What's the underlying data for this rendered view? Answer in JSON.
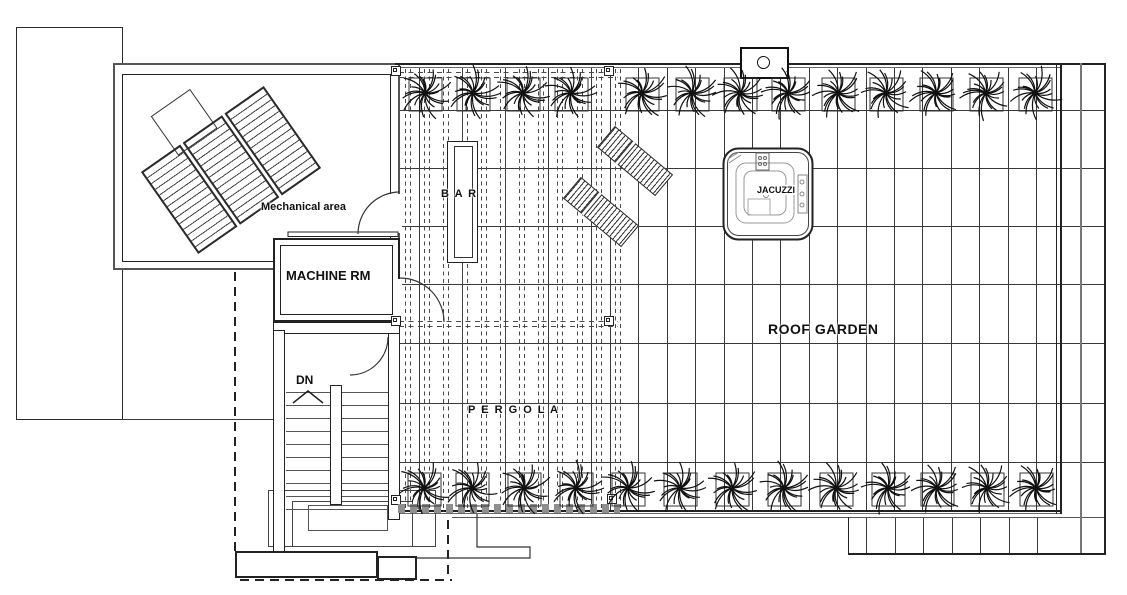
{
  "labels": {
    "mechanical_area": "Mechanical area",
    "machine_room": "MACHINE RM",
    "down": "DN",
    "bar": "B A R",
    "pergola": "P E R G O L A",
    "roof_garden": "ROOF GARDEN",
    "jacuzzi": "JACUZZI"
  },
  "colors": {
    "ink": "#1a1a1a",
    "grid": "#3a3a3a",
    "soft": "#6e6e6e",
    "hatch": "#8f8f8f",
    "paper": "#ffffff"
  },
  "plan": {
    "canvas": {
      "w": 1127,
      "h": 595
    },
    "grid": {
      "h_lines": [
        110,
        168,
        226,
        284,
        343,
        403,
        462
      ],
      "h_x1": 400,
      "h_x2": 1104,
      "v_pergola": [
        419,
        462,
        505,
        548,
        591
      ],
      "v_garden_start": 610,
      "v_garden_end": 1050,
      "v_step": 28.4,
      "v_y1": 68,
      "v_y2": 510,
      "strip_v": [
        866,
        895,
        923,
        952,
        980,
        1009,
        1037
      ],
      "strip_y1": 517,
      "strip_y2": 553
    },
    "rafters": {
      "xs": [
        405,
        424,
        443,
        462,
        481,
        500,
        519,
        538,
        557,
        577,
        596,
        615
      ],
      "pair_gap": 5,
      "y1": 69,
      "y2": 509
    },
    "beams": {
      "ys": [
        72,
        77,
        321,
        326
      ],
      "x1": 399,
      "x2": 618
    },
    "posts": [
      [
        391,
        66
      ],
      [
        604,
        66
      ],
      [
        391,
        316
      ],
      [
        604,
        316
      ],
      [
        391,
        495
      ],
      [
        607,
        494
      ]
    ],
    "plants": {
      "top": {
        "y": 92,
        "xs": [
          425,
          473,
          523,
          571,
          642,
          692,
          740,
          788,
          838,
          886,
          936,
          986,
          1035
        ]
      },
      "bottom": {
        "y": 487,
        "xs": [
          424,
          472,
          524,
          576,
          628,
          680,
          732,
          784,
          836,
          888,
          937,
          987,
          1036
        ]
      }
    },
    "chairs": [
      {
        "cx": 635,
        "cy": 161,
        "w": 76,
        "h": 28,
        "angle": 40
      },
      {
        "cx": 601,
        "cy": 212,
        "w": 76,
        "h": 28,
        "angle": 40
      }
    ],
    "stairs": {
      "tread_x1": 286,
      "tread_x2": 388,
      "tread_y1": 392,
      "tread_y2": 509,
      "tread_step": 13
    }
  }
}
